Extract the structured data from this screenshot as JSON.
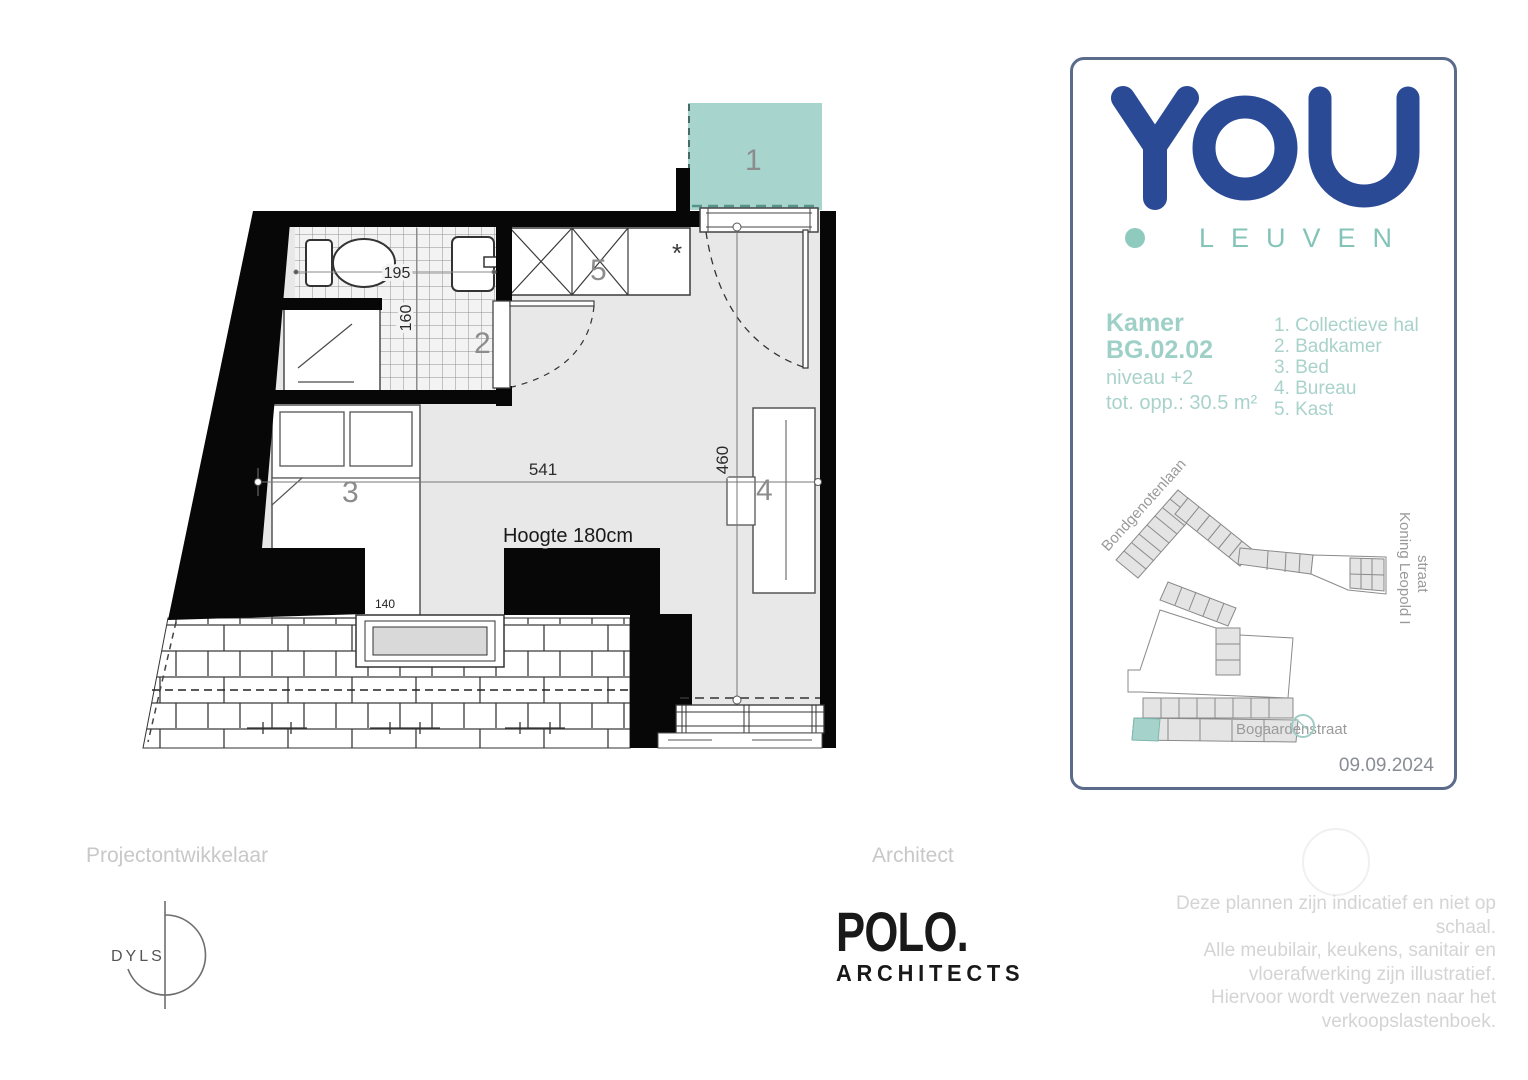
{
  "plan": {
    "labels": {
      "hall": "1",
      "bathroom": "2",
      "bed": "3",
      "desk": "4",
      "closet": "5",
      "asterisk": "*"
    },
    "dims": {
      "room_width": "541",
      "room_depth": "460",
      "bath_width": "195",
      "bath_depth": "160",
      "bed_width": "140",
      "height_note": "Hoogte 180cm"
    }
  },
  "card": {
    "brand": {
      "name": "YOU",
      "city": "LEUVEN"
    },
    "unit": {
      "type_label": "Kamer",
      "code": "BG.02.02",
      "level": "niveau +2",
      "area": "tot. opp.: 30.5 m²"
    },
    "legend": [
      "1. Collectieve hal",
      "2. Badkamer",
      "3. Bed",
      "4. Bureau",
      "5. Kast"
    ],
    "map": {
      "streets": {
        "top": "Bondgenotenlaan",
        "right_line1": "Koning Leopold I",
        "right_line2": "straat",
        "bottom": "Bogaardenstraat"
      }
    },
    "date": "09.09.2024"
  },
  "footer": {
    "developer_label": "Projectontwikkelaar",
    "developer_name": "DYLS",
    "architect_label": "Architect",
    "architect_name": "POLO.",
    "architect_sub": "ARCHITECTS",
    "disclaimer_lines": [
      "Deze plannen zijn indicatief en niet op",
      "schaal.",
      "Alle meubilair, keukens, sanitair en",
      "vloerafwerking zijn illustratief.",
      "Hiervoor wordt verwezen naar het",
      "verkoopslastenboek."
    ]
  },
  "colors": {
    "accent_teal": "#a7d4cd",
    "brand_blue": "#2a4a96",
    "text_teal": "#9ed0c7",
    "leuven_teal": "#84c4b8",
    "card_border": "#5b6b8c",
    "floor_gray": "#e8e8e8",
    "wall_black": "#070707"
  }
}
